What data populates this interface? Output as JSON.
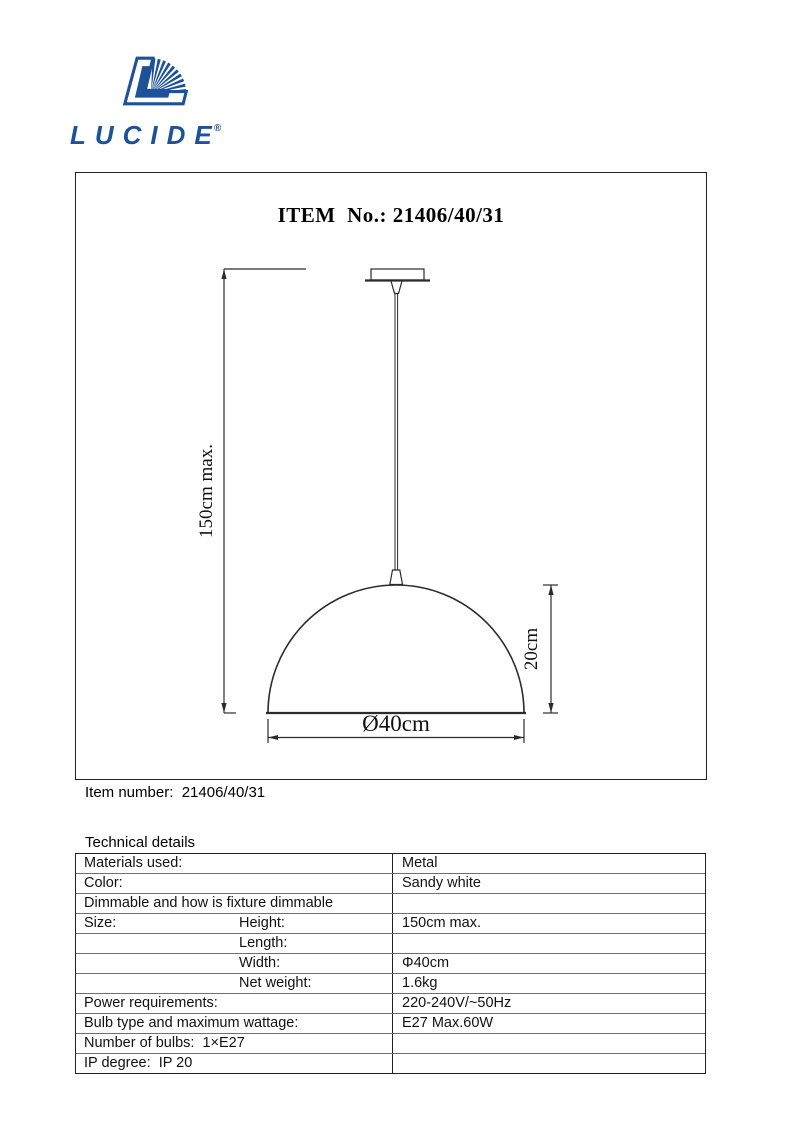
{
  "logo": {
    "brand": "LUCIDE",
    "registered": "®",
    "color": "#1d5299"
  },
  "drawing": {
    "title": "ITEM  No.: 21406/40/31",
    "dim_height_label": "150cm max.",
    "dim_shade_height_label": "20cm",
    "dim_diameter_label": "Ø40cm"
  },
  "item_line": {
    "label": "Item number:",
    "value": "21406/40/31"
  },
  "tech": {
    "heading": "Technical details",
    "rows": [
      {
        "label": "Materials used:",
        "sublabel": "",
        "value": "Metal"
      },
      {
        "label": "Color:",
        "sublabel": "",
        "value": "Sandy white"
      },
      {
        "label": "Dimmable and how is fixture dimmable",
        "sublabel": "",
        "value": ""
      },
      {
        "label": "Size:",
        "sublabel": "Height:",
        "value": "150cm max."
      },
      {
        "label": "",
        "sublabel": "Length:",
        "value": ""
      },
      {
        "label": "",
        "sublabel": "Width:",
        "value": "Φ40cm"
      },
      {
        "label": "",
        "sublabel": "Net weight:",
        "value": "1.6kg"
      },
      {
        "label": "Power requirements:",
        "sublabel": "",
        "value": "220-240V/~50Hz"
      },
      {
        "label": "Bulb type and maximum wattage:",
        "sublabel": "",
        "value": "E27 Max.60W"
      },
      {
        "label": "Number of bulbs:  1×E27",
        "sublabel": "",
        "value": ""
      },
      {
        "label": "IP degree:  IP 20",
        "sublabel": "",
        "value": ""
      }
    ]
  }
}
